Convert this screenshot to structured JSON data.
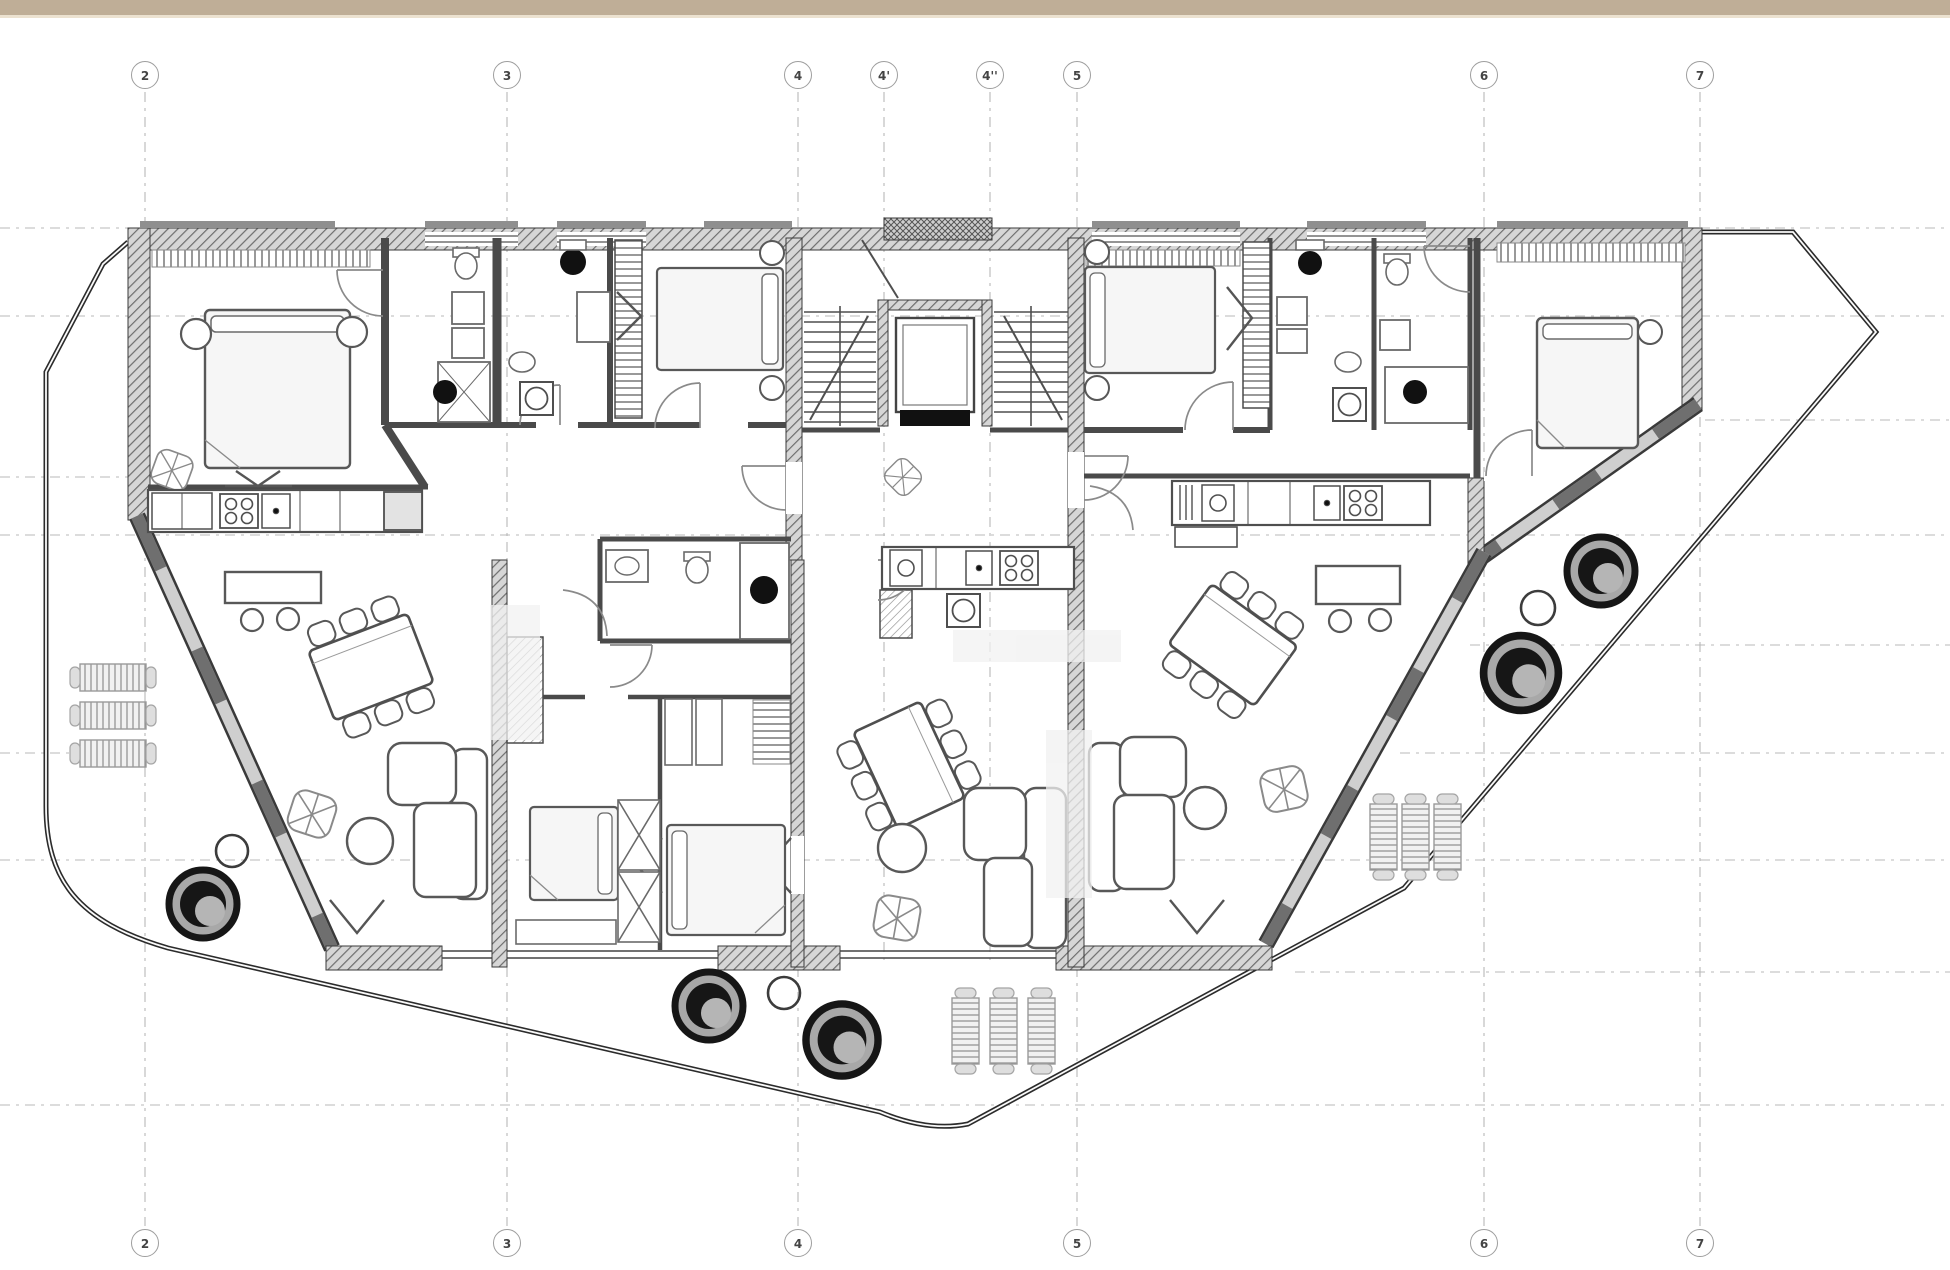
{
  "drawing": {
    "type": "architectural floor plan",
    "description": "Residential floor plan with three apartments, central stair and elevator core, wrap-around terrace with planters and sun loungers"
  },
  "top_bar": {
    "color": "#bfae97"
  },
  "grid": {
    "top_labels": [
      "2",
      "3",
      "4",
      "4'",
      "4''",
      "5",
      "6",
      "7"
    ],
    "bottom_labels": [
      "2",
      "3",
      "4",
      "5",
      "6",
      "7"
    ]
  },
  "colors": {
    "background": "#ffffff",
    "wall_dark": "#3a3a3a",
    "wall_fill": "#d6d6d6",
    "grid_line": "#b8b8b8",
    "bubble_stroke": "#9e9e9e",
    "bubble_text": "#444444",
    "furniture_line": "#585858",
    "railing": "#2b2b2b",
    "planter_dark": "#161616",
    "planter_gray": "#a8a8a8"
  }
}
